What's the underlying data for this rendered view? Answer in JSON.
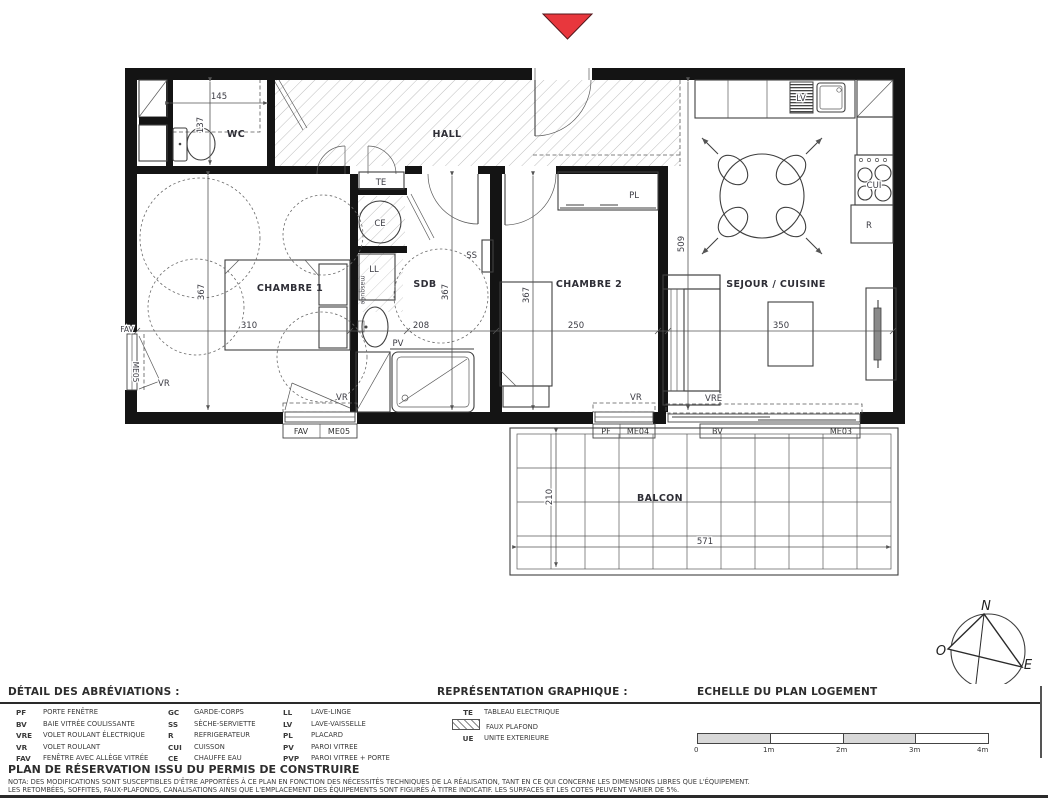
{
  "plan": {
    "rooms": {
      "wc": "WC",
      "hall": "HALL",
      "chambre1": "CHAMBRE 1",
      "sdb": "SDB",
      "chambre2": "CHAMBRE 2",
      "sejour": "SEJOUR / CUISINE",
      "balcon": "BALCON"
    },
    "dims": {
      "wc_w": "145",
      "wc_d": "137",
      "ch1_w": "310",
      "ch1_d": "367",
      "sdb_w": "208",
      "sdb_d": "367",
      "ch2_w": "250",
      "ch2_d": "367",
      "sejour_w": "350",
      "sejour_d": "509",
      "balcon_w": "571",
      "balcon_d": "210"
    },
    "equip": {
      "te": "TE",
      "ce": "CE",
      "ll": "LL",
      "lv": "LV",
      "cui": "CUI",
      "r": "R",
      "ss": "SS",
      "pl": "PL",
      "pv": "PV",
      "masked": "masquée"
    },
    "openings": {
      "left": {
        "type": "FAV",
        "code": "ME05",
        "shutter": "VR"
      },
      "ch1": {
        "type": "FAV",
        "code": "ME05",
        "shutter": "VR"
      },
      "ch2": {
        "type": "PF",
        "code": "ME04",
        "shutter": "VR"
      },
      "bay": {
        "type": "BV",
        "code": "ME03",
        "shutter": "VRE"
      }
    },
    "compass": {
      "n": "N",
      "s": "S",
      "e": "E",
      "o": "O"
    }
  },
  "legend": {
    "abbreviations_title": "DÉTAIL DES ABRÉVIATIONS :",
    "graphics_title": "REPRÉSENTATION GRAPHIQUE :",
    "scale_title": "ECHELLE DU PLAN LOGEMENT",
    "abbreviations": {
      "col1": [
        {
          "abbr": "PF",
          "label": "PORTE FENÊTRE"
        },
        {
          "abbr": "BV",
          "label": "BAIE VITRÉE COULISSANTE"
        },
        {
          "abbr": "VRE",
          "label": "VOLET ROULANT ÉLECTRIQUE"
        },
        {
          "abbr": "VR",
          "label": "VOLET ROULANT"
        },
        {
          "abbr": "FAV",
          "label": "FENÊTRE AVEC ALLÈGE VITRÉE"
        }
      ],
      "col2": [
        {
          "abbr": "GC",
          "label": "GARDE-CORPS"
        },
        {
          "abbr": "SS",
          "label": "SÈCHE-SERVIETTE"
        },
        {
          "abbr": "R",
          "label": "REFRIGERATEUR"
        },
        {
          "abbr": "CUI",
          "label": "CUISSON"
        },
        {
          "abbr": "CE",
          "label": "CHAUFFE EAU"
        }
      ],
      "col3": [
        {
          "abbr": "LL",
          "label": "LAVE-LINGE"
        },
        {
          "abbr": "LV",
          "label": "LAVE-VAISSELLE"
        },
        {
          "abbr": "PL",
          "label": "PLACARD"
        },
        {
          "abbr": "PV",
          "label": "PAROI VITREE"
        },
        {
          "abbr": "PVP",
          "label": "PAROI VITREE + PORTE"
        }
      ]
    },
    "graphics": [
      {
        "abbr": "TE",
        "label": "TABLEAU ELECTRIQUE"
      },
      {
        "abbr": "",
        "label": "FAUX PLAFOND"
      },
      {
        "abbr": "UE",
        "label": "UNITE EXTERIEURE"
      }
    ],
    "scale_ticks": [
      "0",
      "1m",
      "2m",
      "3m",
      "4m"
    ],
    "plan_title": "PLAN DE RÉSERVATION ISSU DU PERMIS DE CONSTRUIRE",
    "nota_line1": "NOTA: DES MODIFICATIONS SONT SUSCEPTIBLES D'ÊTRE APPORTÉES À CE PLAN EN FONCTION DES NÉCESSITÉS TECHNIQUES DE LA RÉALISATION, TANT EN CE QUI CONCERNE LES DIMENSIONS LIBRES QUE L'ÉQUIPEMENT.",
    "nota_line2": "LES RETOMBÉES, SOFFITES, FAUX-PLAFONDS, CANALISATIONS AINSI QUE L'EMPLACEMENT DES ÉQUIPEMENTS SONT FIGURÉS À TITRE INDICATIF. LES SURFACES ET LES COTES PEUVENT VARIER DE 5%.",
    "accent_red": "#e8373d"
  }
}
